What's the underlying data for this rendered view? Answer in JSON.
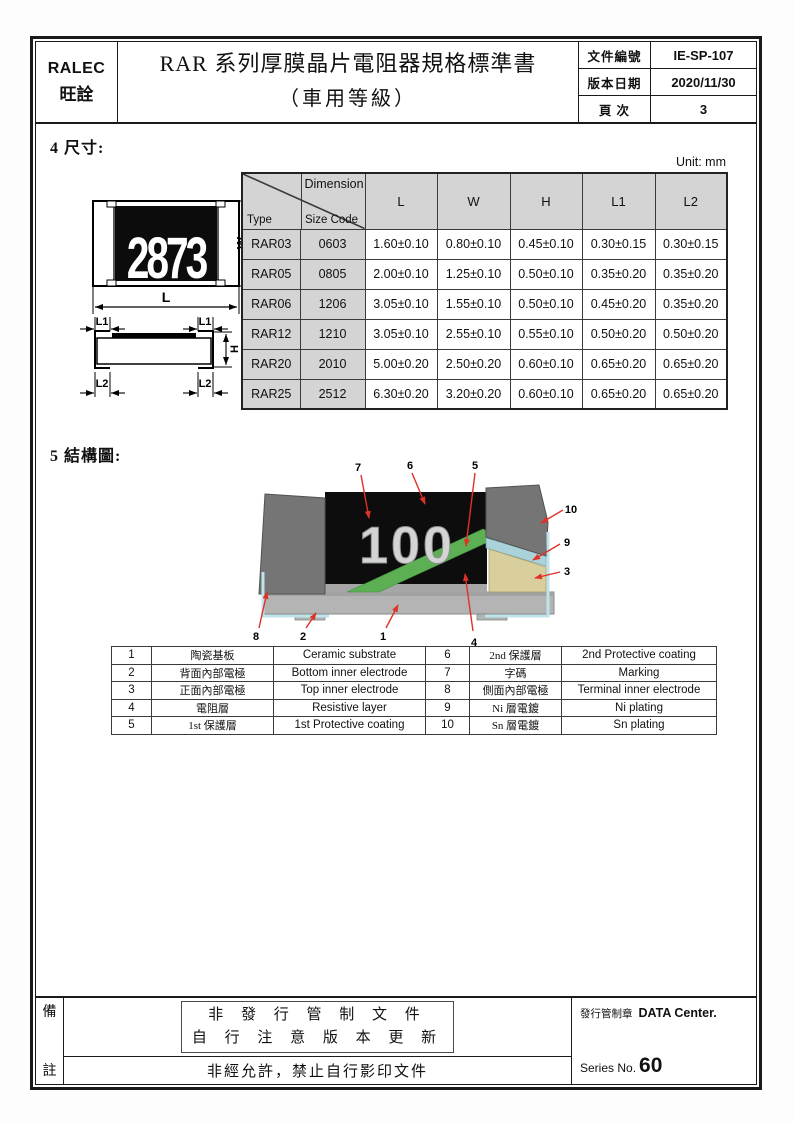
{
  "header": {
    "company_en": "RALEC",
    "company_cn": "旺詮",
    "title": "RAR 系列厚膜晶片電阻器規格標準書",
    "subtitle": "（車用等級）",
    "doc_fields": [
      {
        "label": "文件編號",
        "value": "IE-SP-107"
      },
      {
        "label": "版本日期",
        "value": "2020/11/30"
      },
      {
        "label": "頁 次",
        "value": "3"
      }
    ]
  },
  "section_dimensions": {
    "heading": "4 尺寸:",
    "unit_note": "Unit: mm",
    "top_view": {
      "marking": "2873",
      "width_label": "W",
      "length_label": "L"
    },
    "side_view": {
      "l1_label": "L1",
      "l2_label": "L2",
      "h_label": "H"
    },
    "table": {
      "corner_top": "Dimension",
      "corner_left": "Type",
      "corner_right": "Size Code",
      "columns": [
        "L",
        "W",
        "H",
        "L1",
        "L2"
      ],
      "rows": [
        {
          "type": "RAR03",
          "size": "0603",
          "l": "1.60±0.10",
          "w": "0.80±0.10",
          "h": "0.45±0.10",
          "l1": "0.30±0.15",
          "l2": "0.30±0.15"
        },
        {
          "type": "RAR05",
          "size": "0805",
          "l": "2.00±0.10",
          "w": "1.25±0.10",
          "h": "0.50±0.10",
          "l1": "0.35±0.20",
          "l2": "0.35±0.20"
        },
        {
          "type": "RAR06",
          "size": "1206",
          "l": "3.05±0.10",
          "w": "1.55±0.10",
          "h": "0.50±0.10",
          "l1": "0.45±0.20",
          "l2": "0.35±0.20"
        },
        {
          "type": "RAR12",
          "size": "1210",
          "l": "3.05±0.10",
          "w": "2.55±0.10",
          "h": "0.55±0.10",
          "l1": "0.50±0.20",
          "l2": "0.50±0.20"
        },
        {
          "type": "RAR20",
          "size": "2010",
          "l": "5.00±0.20",
          "w": "2.50±0.20",
          "h": "0.60±0.10",
          "l1": "0.65±0.20",
          "l2": "0.65±0.20"
        },
        {
          "type": "RAR25",
          "size": "2512",
          "l": "6.30±0.20",
          "w": "3.20±0.20",
          "h": "0.60±0.10",
          "l1": "0.65±0.20",
          "l2": "0.65±0.20"
        }
      ]
    }
  },
  "section_structure": {
    "heading": "5 結構圖:",
    "marking": "100",
    "callouts": {
      "1": "1",
      "2": "2",
      "3": "3",
      "4": "4",
      "5": "5",
      "6": "6",
      "7": "7",
      "8": "8",
      "9": "9",
      "10": "10"
    },
    "legend": [
      {
        "no": "1",
        "cn": "陶瓷基板",
        "en": "Ceramic substrate"
      },
      {
        "no": "2",
        "cn": "背面內部電極",
        "en": "Bottom inner electrode"
      },
      {
        "no": "3",
        "cn": "正面內部電極",
        "en": "Top inner electrode"
      },
      {
        "no": "4",
        "cn": "電阻層",
        "en": "Resistive layer"
      },
      {
        "no": "5",
        "cn": "1st 保護層",
        "en": "1st Protective coating"
      },
      {
        "no": "6",
        "cn": "2nd 保護層",
        "en": "2nd Protective coating"
      },
      {
        "no": "7",
        "cn": "字碼",
        "en": "Marking"
      },
      {
        "no": "8",
        "cn": "側面內部電極",
        "en": "Terminal inner electrode"
      },
      {
        "no": "9",
        "cn": "Ni 層電鍍",
        "en": "Ni plating"
      },
      {
        "no": "10",
        "cn": "Sn 層電鍍",
        "en": "Sn plating"
      }
    ]
  },
  "footer": {
    "note_label_top": "備",
    "note_label_bottom": "註",
    "notice_line1": "非 發 行 管 制 文 件",
    "notice_line2": "自 行 注 意 版 本 更 新",
    "copy_restriction": "非經允許，禁止自行影印文件",
    "stamp_label": "發行管制章",
    "stamp_value": "DATA Center.",
    "series_label": "Series No.",
    "series_value": "60"
  },
  "colors": {
    "arrow_red": "#e03127",
    "table_header_gray": "#d4d4d4",
    "layer_green": "#5cb053",
    "layer_ni_blue": "#a9d2d9",
    "layer_sn_blue": "#bfe3ea",
    "layer_tan": "#d8cf9d",
    "substrate_gray": "#b4b4b4",
    "cap_gray": "#757575",
    "body_black": "#0d0d0d"
  }
}
